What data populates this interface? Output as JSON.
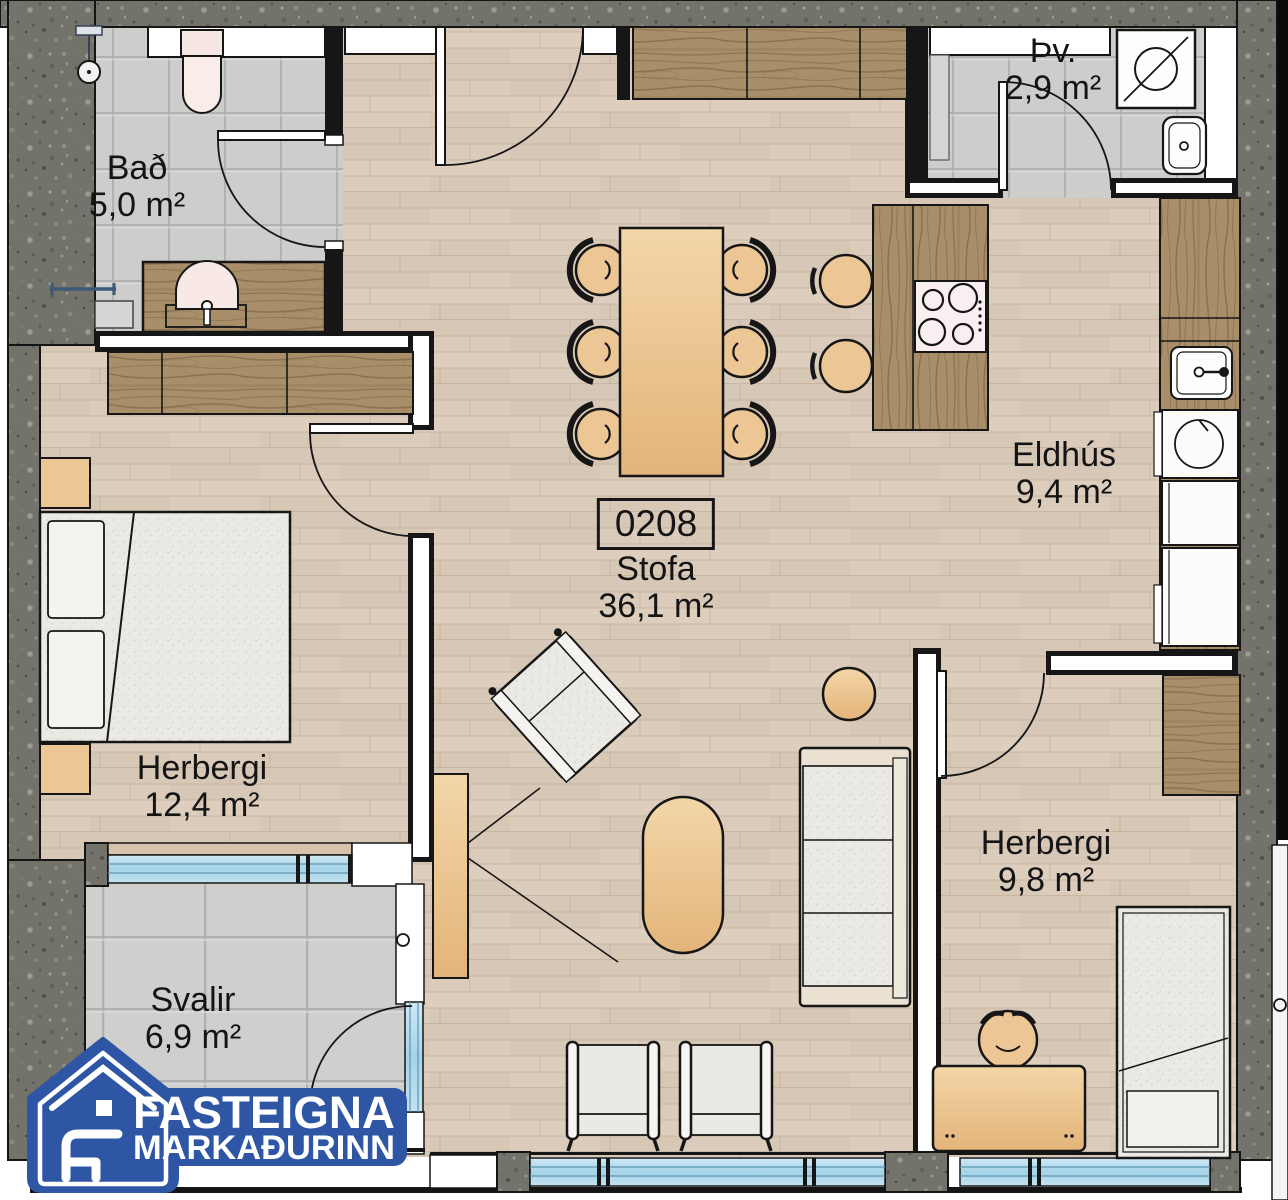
{
  "plan": {
    "unit_number": "0208",
    "rooms": [
      {
        "name": "Bað",
        "area": "5,0 m²"
      },
      {
        "name": "Þv.",
        "area": "2,9 m²"
      },
      {
        "name": "Eldhús",
        "area": "9,4 m²"
      },
      {
        "name": "Stofa",
        "area": "36,1 m²"
      },
      {
        "name": "Herbergi",
        "area": "12,4 m²"
      },
      {
        "name": "Herbergi",
        "area": "9,8 m²"
      },
      {
        "name": "Svalir",
        "area": "6,9 m²"
      }
    ]
  },
  "logo": {
    "line1": "FASTEIGNA",
    "line2": "MARKAÐURINN"
  },
  "colors": {
    "logo_blue": "#2e56a5",
    "wall_granite": "#73736b",
    "floor_wood": "#dacbbb",
    "tile_gray": "#cdcdcb",
    "window_glass": "#a6d3e8",
    "furniture_tan": "#ecc694"
  }
}
